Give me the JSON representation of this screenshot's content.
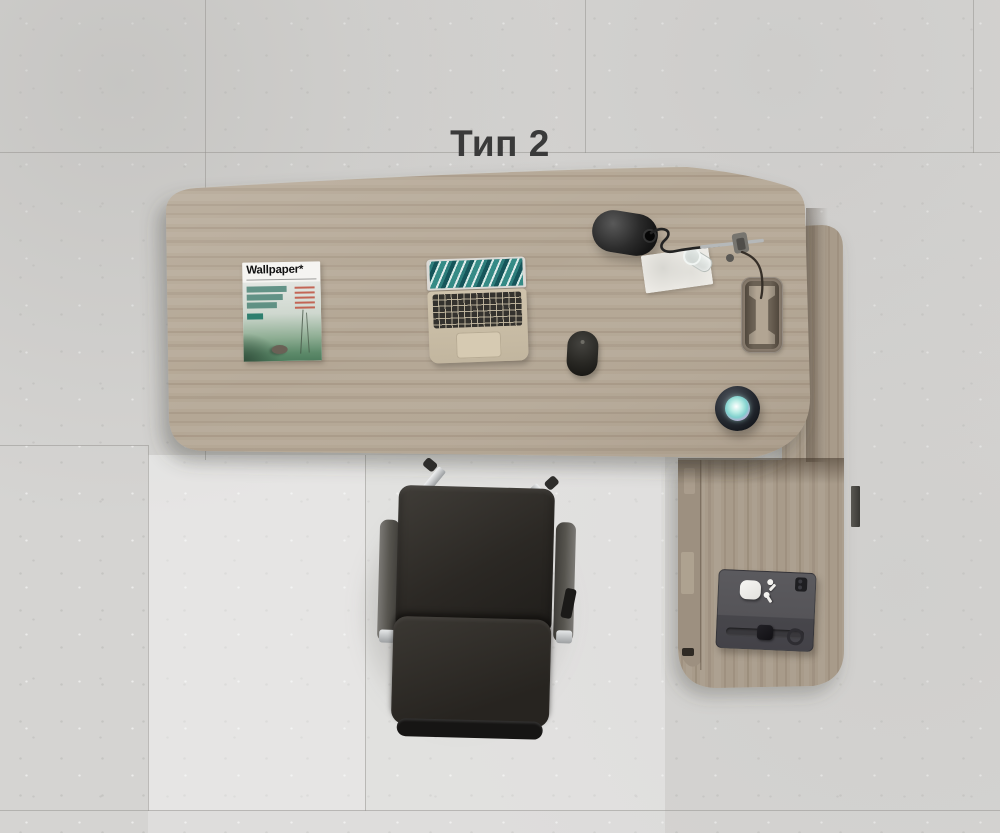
{
  "scene": {
    "caption": "Тип 2",
    "magazine": {
      "masthead": "Wallpaper*"
    },
    "colors": {
      "floor": "#d5d4d2",
      "floor_light_tile": "#ecedeb",
      "desk_wood": "#b4a795",
      "return_wood": "#a89b8a",
      "cabinet_face": "#9d9080",
      "chair_leather": "#2c2925",
      "chair_chrome": "#d6d8d9",
      "lamp_black": "#1d1d1d",
      "caption_text": "#3a3a3a",
      "speaker_glow": "#8fdcd2",
      "magazine_teal": "#4a9183",
      "magazine_red": "#c75040",
      "laptop_body": "#c9bda6",
      "laptop_screen": "#2e7d7b"
    },
    "objects": [
      "desk",
      "side-return-cabinet",
      "office-chair",
      "laptop",
      "magazine",
      "desk-lamp",
      "paper-pad",
      "drinking-glass",
      "computer-mouse",
      "smart-speaker",
      "cable-grommet",
      "tablet-case",
      "airpods-case",
      "earbuds",
      "smartwatch",
      "edge-bracket"
    ]
  }
}
